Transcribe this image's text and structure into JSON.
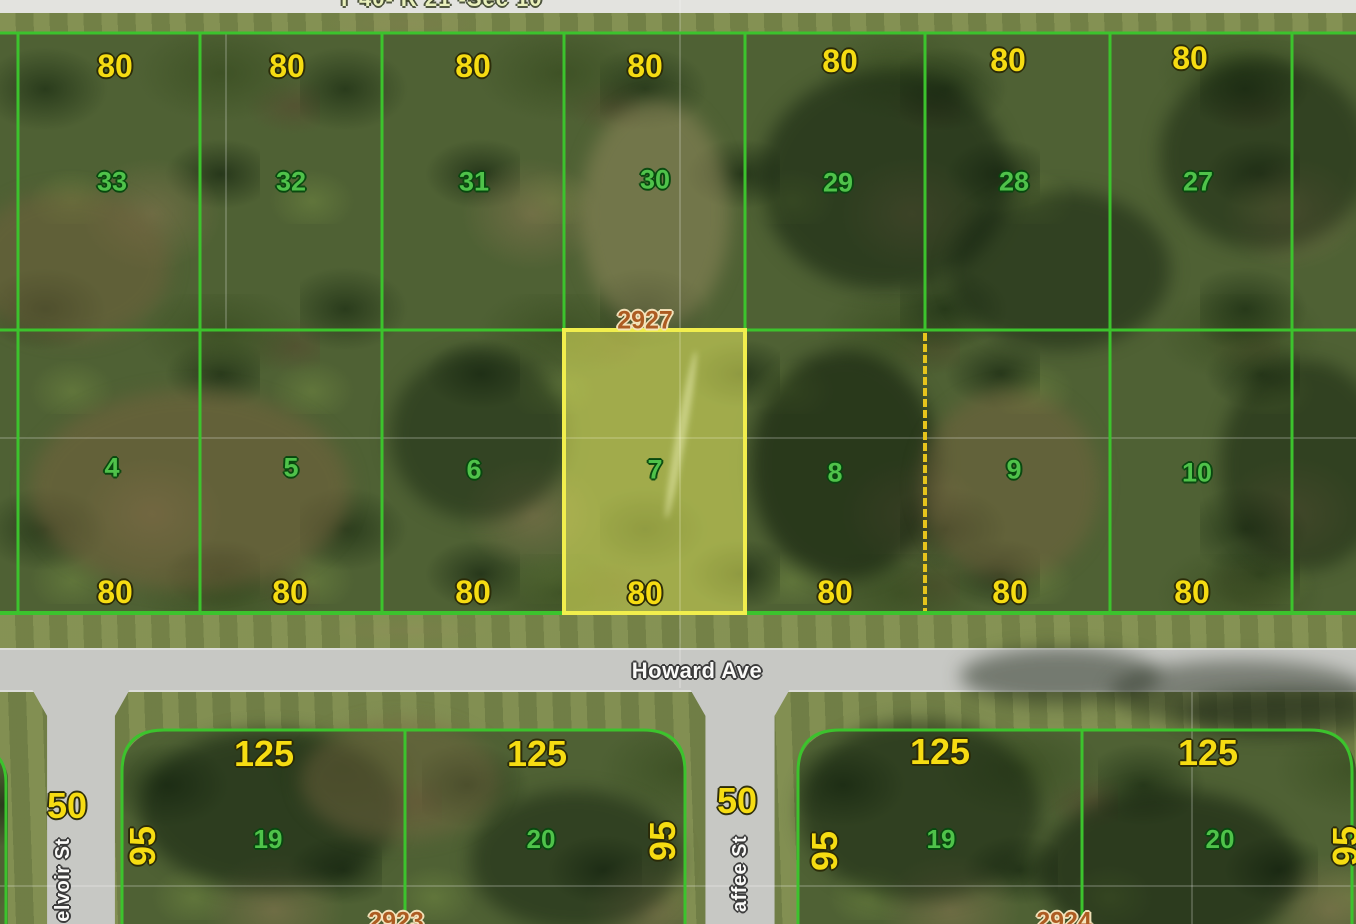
{
  "banner": {
    "text": "T 40- R 21 -Sec 10"
  },
  "streets": {
    "howard": "Howard Ave",
    "belvoir_visible": "elvoir St",
    "chaffee_visible": "affee St"
  },
  "highlight": {
    "lot": "7",
    "address": "2927",
    "border_color": "#f1ee4d",
    "fill_color": "rgba(246,244,88,0.32)"
  },
  "rows": {
    "top": {
      "widths": [
        "80",
        "80",
        "80",
        "80",
        "80",
        "80",
        "80"
      ],
      "lots": [
        "33",
        "32",
        "31",
        "30",
        "29",
        "28",
        "27"
      ]
    },
    "middle": {
      "lots": [
        "4",
        "5",
        "6",
        "7",
        "8",
        "9",
        "10"
      ],
      "widths": [
        "80",
        "80",
        "80",
        "80",
        "80",
        "80",
        "80"
      ]
    },
    "bottom": {
      "depths_125": [
        "125",
        "125",
        "125",
        "125"
      ],
      "lots": [
        "19",
        "20",
        "19",
        "20"
      ],
      "sides_95": [
        "95",
        "95",
        "95",
        "95"
      ],
      "frontages_50": [
        "50",
        "50"
      ],
      "addresses": [
        "2923",
        "2924"
      ]
    }
  },
  "colors": {
    "parcel_line": "#3cc32d",
    "easement_dashed": "#e6c41c",
    "lot_number_green": "#4fc24a",
    "dimension_yellow": "#f6dc12",
    "address_orange": "#ad5c22",
    "street_label_white": "#fafaf8",
    "road_gray": "#c7c8c4"
  }
}
